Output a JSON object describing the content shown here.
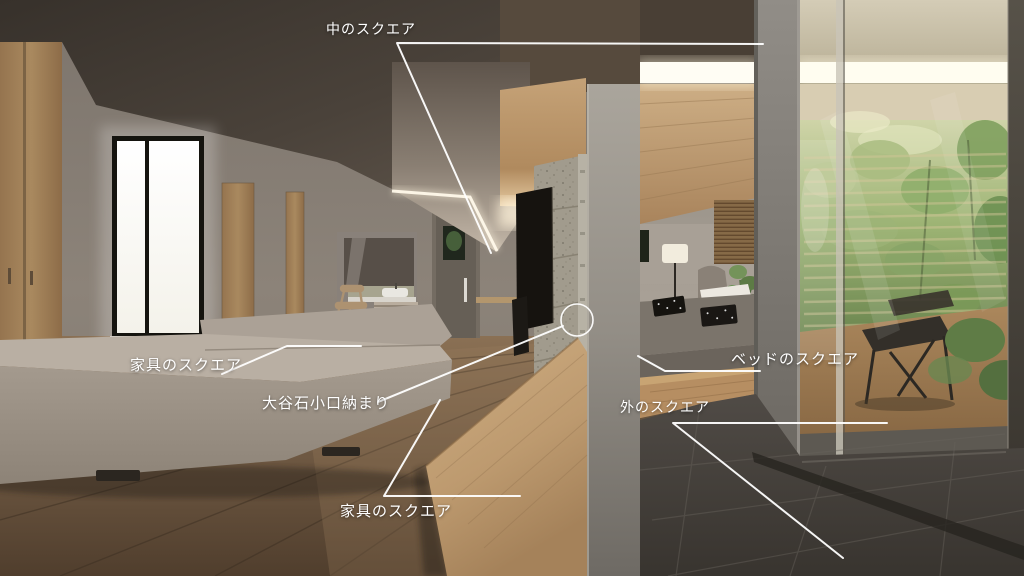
{
  "scene_title": "interior render with construction callouts",
  "annotations": {
    "inner_square": {
      "label": "中のスクエア"
    },
    "furniture_square_left": {
      "label": "家具のスクエア"
    },
    "oya_stone_edge_detail": {
      "label": "大谷石小口納まり"
    },
    "furniture_square_bottom": {
      "label": "家具のスクエア"
    },
    "bed_square": {
      "label": "ベッドのスクエア"
    },
    "outside_square": {
      "label": "外のスクエア"
    }
  },
  "colors": {
    "annotation": "#ffffff",
    "ceiling_dark": "#453d35",
    "wall_greige": "#8a8178",
    "oak_wood": "#a9895f",
    "stone_gray": "#a49e92",
    "floor_wood": "#7a6248",
    "tile_dark": "#45413d",
    "cove_light": "#fff8e6",
    "foliage_green": "#7e9a5f",
    "sofa_greige": "#aca296"
  }
}
